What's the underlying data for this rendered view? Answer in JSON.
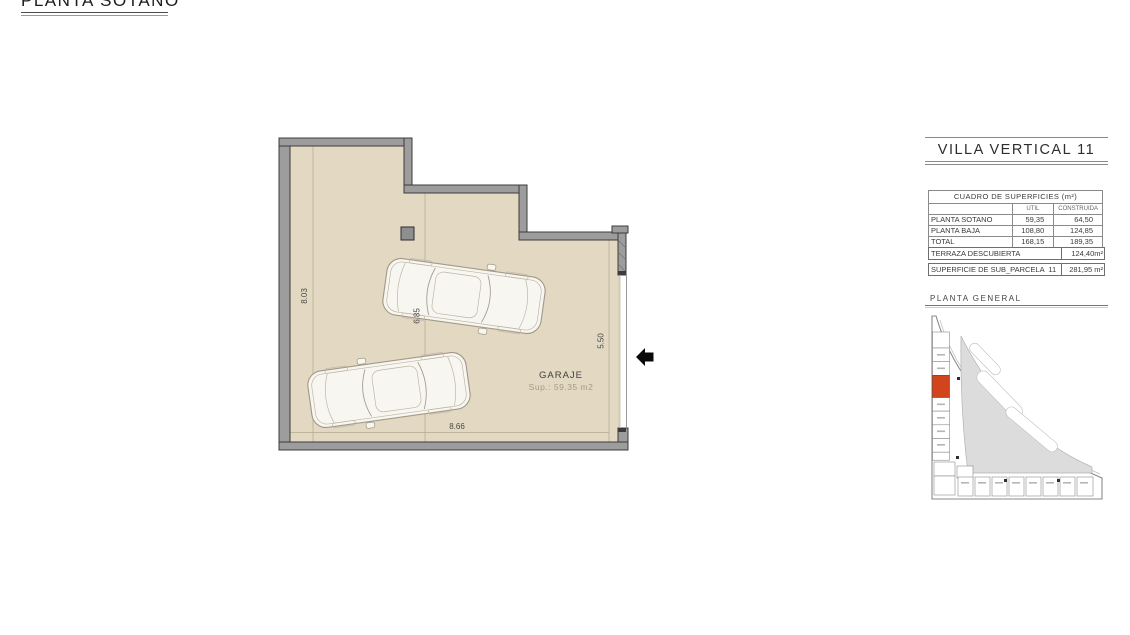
{
  "title": "PLANTA SOTANO",
  "plan": {
    "room": {
      "name": "GARAJE",
      "area": "Sup.: 59.35 m2"
    },
    "dimensions": {
      "height_left": "8.03",
      "height_mid": "6.85",
      "height_right": "5.50",
      "width_bottom": "8.66"
    }
  },
  "sidebar": {
    "title": "VILLA VERTICAL 11",
    "surfaces_table": {
      "caption": "CUADRO DE SUPERFICIES (m²)",
      "columns": {
        "util": "UTIL",
        "construida": "CONSTRUIDA"
      },
      "rows": [
        {
          "label": "PLANTA SOTANO",
          "util": "59,35",
          "construida": "64,50"
        },
        {
          "label": "PLANTA BAJA",
          "util": "108,80",
          "construida": "124,85"
        },
        {
          "label": "TOTAL",
          "util": "168,15",
          "construida": "189,35"
        }
      ]
    },
    "terraza": {
      "label": "TERRAZA DESCUBIERTA",
      "value": "124,40m²"
    },
    "parcela": {
      "label": "SUPERFICIE DE SUB_PARCELA  11",
      "value": "281,95 m²"
    },
    "site_plan_title": "PLANTA GENERAL"
  },
  "colors": {
    "floor": "#e3d8c2",
    "wall": "#9d9d9d",
    "wall_edge": "#3c3c3c",
    "highlight": "#d2441c"
  }
}
